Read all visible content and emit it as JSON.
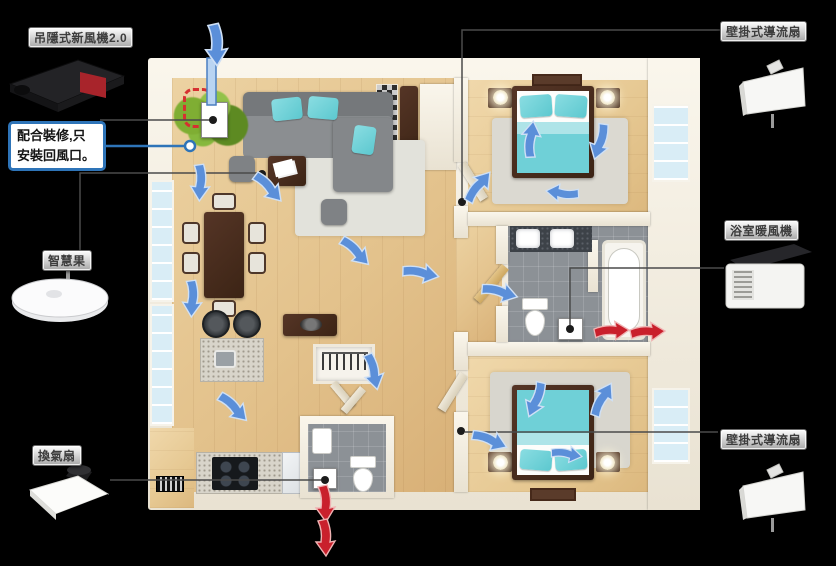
{
  "background_color": "#000000",
  "callout": {
    "line1": "配合裝修,只",
    "line2": "安裝回風口。",
    "border_color": "#2e74b8"
  },
  "labels": {
    "hrv": "吊隱式新風機2.0",
    "sensor": "智慧果",
    "exhaust_fan": "換氣扇",
    "wall_fan_top": "壁掛式導流扇",
    "bath_heater": "浴室暖風機",
    "wall_fan_bottom": "壁掛式導流扇"
  },
  "airflow": {
    "supply_color": "#5b8fd9",
    "supply_edge_color": "#cfe0f5",
    "exhaust_color": "#c9202c",
    "exhaust_edge_color": "#efb3b3",
    "blue_arrows": [
      {
        "x": 216,
        "y": 44,
        "angle": 90,
        "scale": 1.15
      },
      {
        "x": 200,
        "y": 182,
        "angle": 95,
        "scale": 1
      },
      {
        "x": 268,
        "y": 187,
        "angle": 50,
        "scale": 1
      },
      {
        "x": 192,
        "y": 298,
        "angle": 95,
        "scale": 1
      },
      {
        "x": 233,
        "y": 407,
        "angle": 48,
        "scale": 1
      },
      {
        "x": 355,
        "y": 251,
        "angle": 48,
        "scale": 1
      },
      {
        "x": 420,
        "y": 273,
        "angle": 14,
        "scale": 1
      },
      {
        "x": 499,
        "y": 292,
        "angle": 18,
        "scale": 1
      },
      {
        "x": 478,
        "y": 187,
        "angle": -48,
        "scale": 1
      },
      {
        "x": 531,
        "y": 140,
        "angle": -80,
        "scale": 1
      },
      {
        "x": 600,
        "y": 141,
        "angle": 110,
        "scale": 1
      },
      {
        "x": 563,
        "y": 193,
        "angle": 190,
        "scale": 0.9
      },
      {
        "x": 489,
        "y": 440,
        "angle": 25,
        "scale": 1
      },
      {
        "x": 536,
        "y": 399,
        "angle": 115,
        "scale": 1
      },
      {
        "x": 602,
        "y": 400,
        "angle": -58,
        "scale": 1
      },
      {
        "x": 566,
        "y": 454,
        "angle": 12,
        "scale": 0.85
      },
      {
        "x": 373,
        "y": 371,
        "angle": 80,
        "scale": 1
      }
    ],
    "red_arrows": [
      {
        "x": 611,
        "y": 331,
        "angle": 0,
        "scale": 0.95
      },
      {
        "x": 647,
        "y": 332,
        "angle": 0,
        "scale": 0.95
      },
      {
        "x": 325,
        "y": 503,
        "angle": 90,
        "scale": 1
      },
      {
        "x": 325,
        "y": 537,
        "angle": 90,
        "scale": 1
      }
    ]
  },
  "connectors": [
    {
      "id": "hrv-line",
      "color": "#4a4a4a",
      "width": 1.5,
      "points": [
        [
          100,
          120
        ],
        [
          211,
          120
        ]
      ],
      "dot": [
        213,
        120
      ]
    },
    {
      "id": "callout-line",
      "color": "#2e74b8",
      "width": 2.5,
      "points": [
        [
          101,
          146
        ],
        [
          185,
          146
        ]
      ],
      "ring": [
        190,
        146
      ]
    },
    {
      "id": "sensor-line",
      "color": "#4a4a4a",
      "width": 1.5,
      "points": [
        [
          80,
          251
        ],
        [
          80,
          173
        ],
        [
          258,
          173
        ]
      ],
      "dot": [
        262,
        174
      ]
    },
    {
      "id": "exhaust-fan-line",
      "color": "#4a4a4a",
      "width": 1.5,
      "points": [
        [
          110,
          480
        ],
        [
          321,
          480
        ]
      ],
      "dot": [
        325,
        480
      ]
    },
    {
      "id": "wall-fan-top-line",
      "color": "#4a4a4a",
      "width": 1.5,
      "points": [
        [
          720,
          30
        ],
        [
          462,
          30
        ],
        [
          462,
          199
        ]
      ],
      "dot": [
        462,
        202
      ]
    },
    {
      "id": "bath-heater-line",
      "color": "#4a4a4a",
      "width": 1.5,
      "points": [
        [
          724,
          268
        ],
        [
          570,
          268
        ],
        [
          570,
          326
        ]
      ],
      "dot": [
        570,
        329
      ]
    },
    {
      "id": "wall-fan-bottom-line",
      "color": "#4a4a4a",
      "width": 1.5,
      "points": [
        [
          718,
          432
        ],
        [
          465,
          432
        ]
      ],
      "dot": [
        461,
        431
      ]
    }
  ]
}
